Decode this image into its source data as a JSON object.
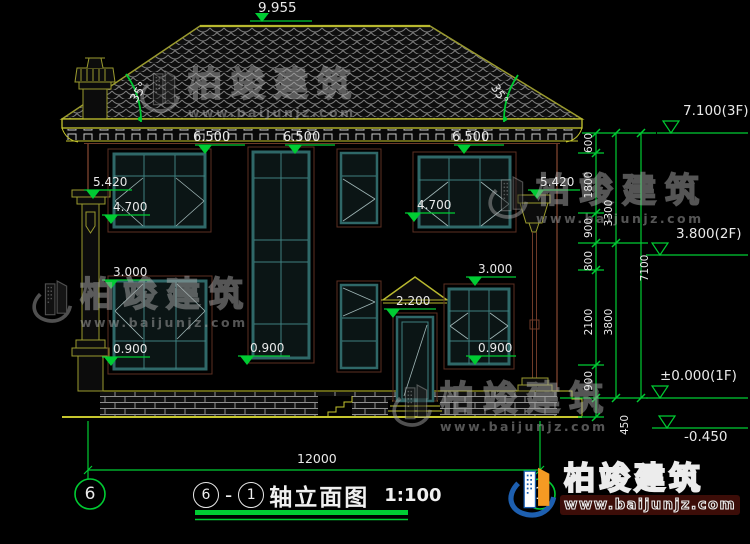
{
  "watermark": {
    "brand": "柏竣建筑",
    "url": "www.baijunjz.com"
  },
  "logo": {
    "brand": "柏竣建筑",
    "url": "www.baijunjz.com"
  },
  "title_bar": {
    "axis_start": "6",
    "separator": "-",
    "axis_end": "1",
    "name": "轴立面图",
    "scale": "1:100"
  },
  "axes": {
    "left_bubble": "6",
    "right_bubble": "1"
  },
  "dims": {
    "ridge": "9.955",
    "angle_left": "35°",
    "angle_right": "35°",
    "eave": [
      "6.500",
      "6.500",
      "6.500"
    ],
    "left": {
      "v5420": "5.420",
      "v4700": "4.700",
      "v3000": "3.000",
      "v0900": "0.900"
    },
    "right": {
      "v5420": "5.420",
      "v4700": "4.700",
      "v3000": "3.000",
      "v0900": "0.900"
    },
    "center": {
      "sill": "0.900",
      "canopy": "2.200"
    },
    "chain": {
      "seg": [
        "600",
        "1800",
        "900",
        "800",
        "2100",
        "900",
        "450"
      ],
      "sub": [
        "3300",
        "3800"
      ],
      "total": "7100"
    },
    "levels": {
      "f3": "7.100(3F)",
      "f2": "3.800(2F)",
      "f1": "±0.000(1F)",
      "ground": "-0.450"
    },
    "width": "12000"
  },
  "colors": {
    "background": "#000000",
    "dimension_green": "#00cc33",
    "text_white": "#e9e9e9",
    "trim_yellow": "#c6c62e",
    "roof_outline": "#9a9a2e",
    "wall_brown": "#6e3a28",
    "window_teal": "#2f6868",
    "watermark_gray": "#a9a9a9",
    "logo_blue": "#1d5fb0",
    "logo_orange": "#f59a23"
  }
}
